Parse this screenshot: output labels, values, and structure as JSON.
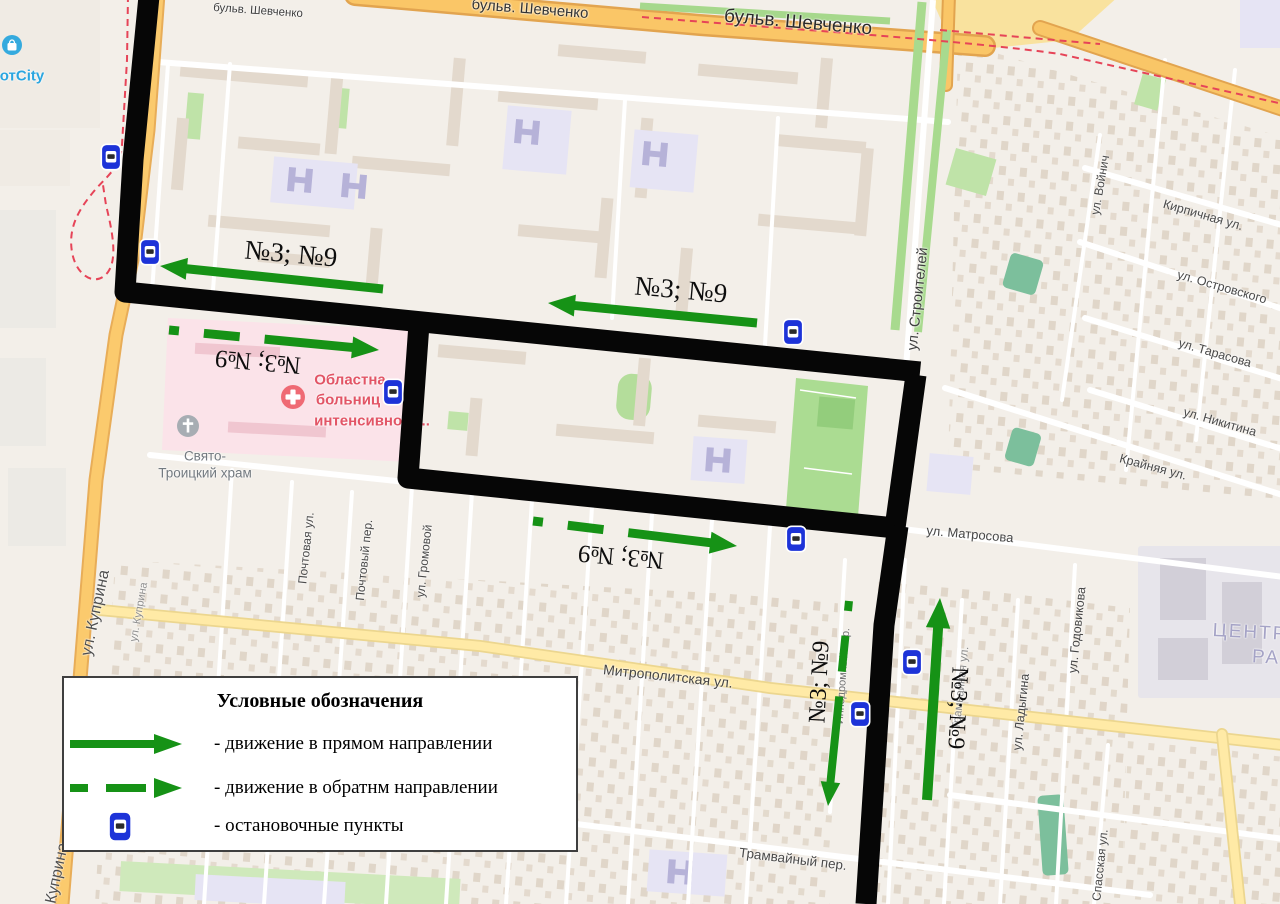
{
  "legend": {
    "title": "Условные обозначения",
    "items": [
      {
        "symbol": "solid-arrow-icon",
        "label": "- движение в прямом направлении"
      },
      {
        "symbol": "dashed-arrow-icon",
        "label": "- движение в обратнм направлении"
      },
      {
        "symbol": "bus-stop-icon",
        "label": "- остановочные пункты"
      }
    ]
  },
  "route": {
    "color": "#060606",
    "width": 21,
    "paths": [
      "M150,-14 L133,160 L125,292 L920,372",
      "M419,324 L408,478 L895,528 L916,375",
      "M898,526 L884,625 L866,904"
    ]
  },
  "arrows": {
    "color": "#169216",
    "items": [
      {
        "type": "solid",
        "from": [
          383,
          289
        ],
        "to": [
          160,
          266
        ],
        "w": 9
      },
      {
        "type": "solid",
        "from": [
          757,
          323
        ],
        "to": [
          548,
          303
        ],
        "w": 9
      },
      {
        "type": "solid",
        "from": [
          927,
          800
        ],
        "to": [
          940,
          598
        ],
        "w": 10
      },
      {
        "type": "dashed",
        "from": [
          169,
          330
        ],
        "to": [
          379,
          350
        ],
        "w": 9
      },
      {
        "type": "dashed",
        "from": [
          533,
          521
        ],
        "to": [
          737,
          546
        ],
        "w": 9
      },
      {
        "type": "dashed",
        "from": [
          849,
          601
        ],
        "to": [
          828,
          806
        ],
        "w": 8
      }
    ]
  },
  "route_labels": [
    {
      "t": "№3; №9",
      "x": 291,
      "y": 254,
      "r": 5,
      "s": 27
    },
    {
      "t": "№3; №9",
      "x": 681,
      "y": 290,
      "r": 5,
      "s": 27
    },
    {
      "t": "№3; №9",
      "x": 258,
      "y": 361,
      "r": 185,
      "s": 25
    },
    {
      "t": "№3; №9",
      "x": 621,
      "y": 556,
      "r": 185,
      "s": 25
    },
    {
      "t": "№3; №9",
      "x": 820,
      "y": 682,
      "r": -87,
      "s": 24
    },
    {
      "t": "№3; №9",
      "x": 957,
      "y": 708,
      "r": 93,
      "s": 24
    }
  ],
  "bus_stops": [
    [
      111,
      157
    ],
    [
      150,
      252
    ],
    [
      393,
      392
    ],
    [
      793,
      332
    ],
    [
      796,
      539
    ],
    [
      912,
      662
    ],
    [
      860,
      714
    ]
  ],
  "map_labels": [
    {
      "t": "бульв. Шевченко",
      "x": 258,
      "y": 11,
      "r": 4,
      "s": 11.5,
      "c": "#3d3d3d"
    },
    {
      "t": "бульв. Шевченко",
      "x": 530,
      "y": 9,
      "r": 4.5,
      "s": 15,
      "c": "#333333"
    },
    {
      "t": "бульв. Шевченко",
      "x": 798,
      "y": 23,
      "r": 5,
      "s": 19,
      "c": "#2b2b2b"
    },
    {
      "t": "ул. Куприна",
      "x": 96,
      "y": 613,
      "r": -78,
      "s": 16,
      "c": "#4f4f4f"
    },
    {
      "t": "ул. Куприна",
      "x": 139,
      "y": 612,
      "r": -80,
      "s": 11,
      "c": "#8f8f8f"
    },
    {
      "t": "ул. Куприна",
      "x": 55,
      "y": 886,
      "r": -78,
      "s": 16,
      "c": "#4f4f4f"
    },
    {
      "t": "ул. Строителей",
      "x": 918,
      "y": 299,
      "r": -84,
      "s": 14.5,
      "c": "#3f3f3f"
    },
    {
      "t": "ул. Войнич",
      "x": 1100,
      "y": 185,
      "r": -80,
      "s": 12,
      "c": "#4a4a4a"
    },
    {
      "t": "Кирпичная ул.",
      "x": 1203,
      "y": 215,
      "r": 16,
      "s": 12.5,
      "c": "#4a4a4a"
    },
    {
      "t": "ул. Островского",
      "x": 1222,
      "y": 287,
      "r": 16,
      "s": 12.5,
      "c": "#4a4a4a"
    },
    {
      "t": "ул. Тарасова",
      "x": 1215,
      "y": 353,
      "r": 16,
      "s": 12.5,
      "c": "#4a4a4a"
    },
    {
      "t": "ул. Никитина",
      "x": 1220,
      "y": 422,
      "r": 16,
      "s": 12.5,
      "c": "#4a4a4a"
    },
    {
      "t": "Крайняя ул.",
      "x": 1153,
      "y": 467,
      "r": 15,
      "s": 12.5,
      "c": "#4a4a4a"
    },
    {
      "t": "ул. Матросова",
      "x": 970,
      "y": 534,
      "r": 5,
      "s": 13,
      "c": "#454545"
    },
    {
      "t": "Митрополитская ул.",
      "x": 668,
      "y": 676,
      "r": 6,
      "s": 14,
      "c": "#454545"
    },
    {
      "t": "Трамвайный пер.",
      "x": 793,
      "y": 859,
      "r": 7,
      "s": 13.5,
      "c": "#4a4a4a"
    },
    {
      "t": "Почтовая ул.",
      "x": 306,
      "y": 548,
      "r": -84,
      "s": 12,
      "c": "#4a4a4a"
    },
    {
      "t": "Почтовый пер.",
      "x": 364,
      "y": 560,
      "r": -84,
      "s": 12,
      "c": "#4a4a4a"
    },
    {
      "t": "ул. Громовой",
      "x": 424,
      "y": 561,
      "r": -84,
      "s": 12,
      "c": "#4a4a4a"
    },
    {
      "t": "Ипподромный пер.",
      "x": 843,
      "y": 676,
      "r": -86,
      "s": 11,
      "c": "#6f6f6f"
    },
    {
      "t": "Трамвайная ул.",
      "x": 961,
      "y": 688,
      "r": -84,
      "s": 11.5,
      "c": "#8a8a8a"
    },
    {
      "t": "ул. Ладыгина",
      "x": 1021,
      "y": 712,
      "r": -84,
      "s": 12.5,
      "c": "#454545"
    },
    {
      "t": "ул. Годовикова",
      "x": 1077,
      "y": 630,
      "r": -84,
      "s": 12.5,
      "c": "#454545"
    },
    {
      "t": "Спасская ул.",
      "x": 1100,
      "y": 865,
      "r": -84,
      "s": 12,
      "c": "#4a4a4a"
    },
    {
      "t": "отCity",
      "x": 22,
      "y": 76,
      "r": 0,
      "s": 15,
      "c": "#2ba6e0",
      "w": 700
    },
    {
      "t": "Свято-",
      "x": 205,
      "y": 456,
      "r": 0,
      "s": 13.5,
      "c": "#737a80"
    },
    {
      "t": "Троицкий храм",
      "x": 205,
      "y": 473,
      "r": 0,
      "s": 13.5,
      "c": "#737a80"
    },
    {
      "t": "Областна",
      "x": 350,
      "y": 380,
      "r": 0,
      "s": 15,
      "c": "#e25566",
      "w": 700
    },
    {
      "t": "больниц",
      "x": 348,
      "y": 400,
      "r": 0,
      "s": 15,
      "c": "#e25566",
      "w": 700
    },
    {
      "t": "интенсивного...",
      "x": 372,
      "y": 421,
      "r": 0,
      "s": 15,
      "c": "#e25566",
      "w": 700
    },
    {
      "t": "ЦЕНТР",
      "x": 1250,
      "y": 633,
      "r": 3,
      "s": 19,
      "c": "#a5a3c6",
      "ls": 2
    },
    {
      "t": "РА",
      "x": 1266,
      "y": 658,
      "r": 3,
      "s": 19,
      "c": "#a5a3c6",
      "ls": 2
    }
  ]
}
